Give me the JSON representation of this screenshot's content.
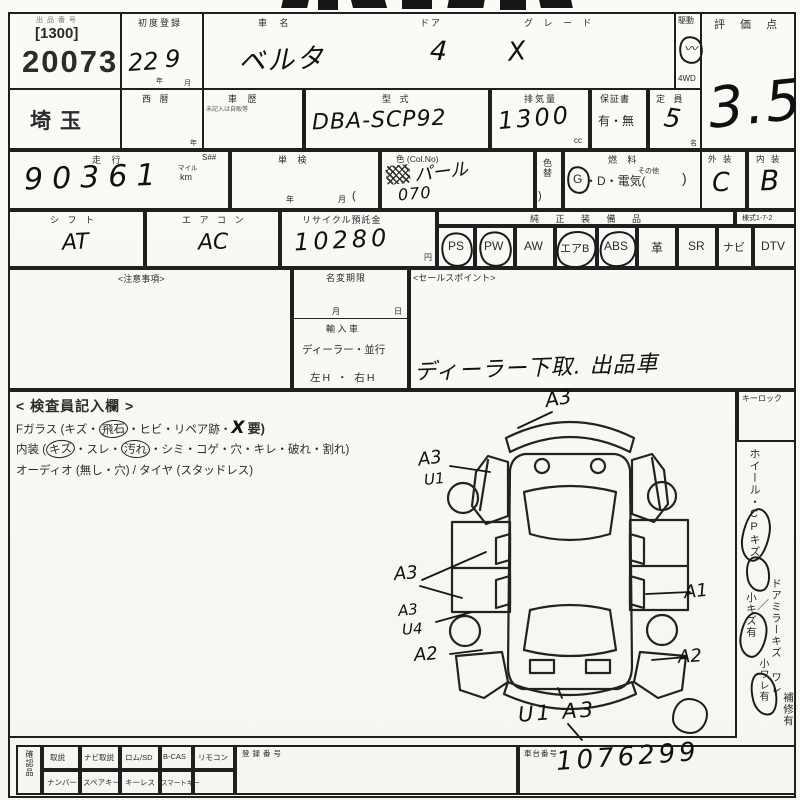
{
  "lot": {
    "label": "出品番号",
    "class_code": "[1300]",
    "number": "20073",
    "region": "埼玉"
  },
  "first_reg": {
    "label": "初度登録",
    "year": "22",
    "year_unit": "年",
    "month": "9",
    "month_unit": "月"
  },
  "car": {
    "name_label": "車  名",
    "name": "ベルタ",
    "doors_label": "ドア",
    "doors": "4",
    "grade_label": "グ レ ー ド",
    "grade": "X",
    "drive_label": "駆動",
    "drive_4wd": "4WD"
  },
  "score": {
    "label": "評 価 点",
    "value": "3.5"
  },
  "row2": {
    "west_label": "西  暦",
    "west_unit": "年",
    "history_label": "車  歴",
    "history_note": "未記入は自販等",
    "model_label": "型  式",
    "model": "DBA-SCP92",
    "disp_label": "排気量",
    "disp": "1300",
    "disp_unit": "cc",
    "warranty_label": "保証書",
    "warranty": "有・無",
    "capacity_label": "定 員",
    "capacity": "5",
    "capacity_unit": "名"
  },
  "row3": {
    "mileage_label": "走  行",
    "s_label": "S##",
    "mileage": "90361",
    "mile_unit": "マイル",
    "km_unit": "km",
    "tanken_label": "単  検",
    "tanken_year": "年",
    "tanken_month": "月",
    "paren_open": "(",
    "color_label": "色 (Col.No)",
    "color": "パール",
    "color_no": "070",
    "color_change": "色替",
    "paren_close": ")",
    "fuel_label": "燃  料",
    "fuel_g": "G",
    "fuel_rest": "・D・電気(",
    "fuel_other": "その他",
    "fuel_close": ")",
    "ext_label": "外 装",
    "ext": "C",
    "int_label": "内 装",
    "int": "B"
  },
  "row4": {
    "shift_label": "シ フ ト",
    "shift": "AT",
    "ac_label": "エ ア コ ン",
    "ac": "AC",
    "recycle_label": "リサイクル預託金",
    "recycle": "10280",
    "yen": "円",
    "equip_label": "純 正 装 備 品",
    "form_no": "様式1-7-2",
    "equipment": [
      {
        "label": "PS",
        "circled": true
      },
      {
        "label": "PW",
        "circled": true
      },
      {
        "label": "AW",
        "circled": false
      },
      {
        "label": "エアB",
        "circled": true
      },
      {
        "label": "ABS",
        "circled": true
      },
      {
        "label": "革",
        "circled": false
      },
      {
        "label": "SR",
        "circled": false
      },
      {
        "label": "ナビ",
        "circled": false
      },
      {
        "label": "DTV",
        "circled": false
      }
    ]
  },
  "notes": {
    "caution": "<注意事項>",
    "namechange": "名変期限",
    "month": "月",
    "day": "日",
    "import_label": "輸 入 車",
    "import_opts": "ディーラー・並行",
    "handle": "左H ・ 右H",
    "sales_label": "<セールスポイント>",
    "sales_text": "ディーラー下取. 出品車"
  },
  "inspector": {
    "title": "< 検査員記入欄 >",
    "fglass_pre": "Fガラス (キズ・",
    "fglass_c": "飛石",
    "fglass_mid": "・ヒビ・リペア跡・",
    "fglass_hand": "X",
    "fglass_post": "要)",
    "int_pre": "内装 (",
    "int_c1": "キズ",
    "int_m1": "・スレ・",
    "int_c2": "汚れ",
    "int_post": "・シミ・コゲ・穴・キレ・破れ・割れ)",
    "audio": "オーディオ (無し・穴) / タイヤ (スタッドレス)"
  },
  "damage": {
    "front": "A3",
    "lf1": "A3",
    "lf2": "U1",
    "ld": "A3",
    "lr1": "A3",
    "lr2": "U4",
    "la2": "A2",
    "rd": "A1",
    "ra2": "A2",
    "rear": "U1 A3"
  },
  "sidebar": {
    "keylock": "キーロック",
    "wheel": "ホイール・CPキズ",
    "small_scratch": "小キズ有",
    "slash": "／",
    "mirror": "ドアミラーキズ ワレ",
    "small_crack": "小ワレ有",
    "repair": "補修有"
  },
  "bottom": {
    "confirm": "確認品",
    "r1c1": "取説",
    "r1c2": "ナビ取説",
    "r1c3": "ロム/SD",
    "r1c4": "B-CAS",
    "r1c5": "リモコン",
    "reg_label": "登録番号",
    "r2c1": "ナンバー",
    "r2c2": "スペアキー",
    "r2c3": "キーレス",
    "r2c4": "スマートキー",
    "vin_label": "車台番号",
    "vin": "1076299"
  }
}
